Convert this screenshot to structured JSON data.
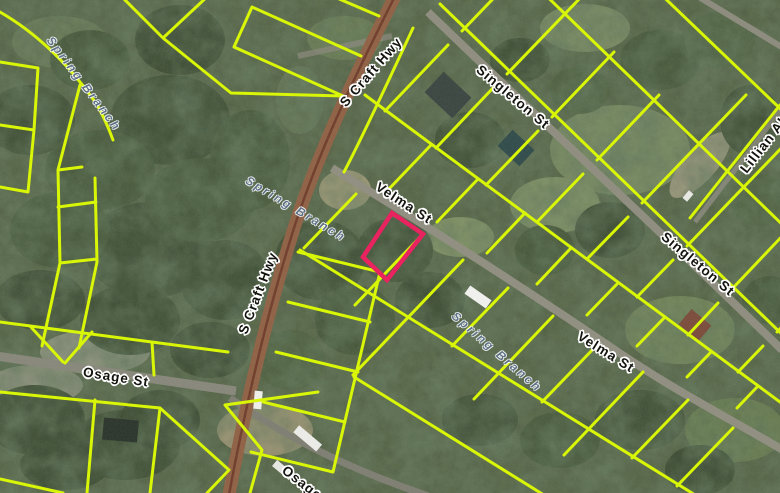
{
  "map": {
    "kind": "gis-parcel-viewer-aerial",
    "width": 780,
    "height": 493,
    "colors": {
      "parcel_line": "#d9f607",
      "highlight": "#e8235f",
      "highway_road": "#8f6044",
      "highway_centerline": "#6f3b2a",
      "local_road": "#8e8c7e",
      "road_label_text": "#14140f",
      "road_label_halo": "#ffffff",
      "stream_label_text": "#5d7186"
    },
    "road_labels": [
      {
        "text": "S Craft Hwy",
        "x": 371,
        "y": 72,
        "rotation": -49
      },
      {
        "text": "Singleton St",
        "x": 513,
        "y": 97,
        "rotation": 40
      },
      {
        "text": "Velma St",
        "x": 404,
        "y": 203,
        "rotation": 33
      },
      {
        "text": "S Craft Hwy",
        "x": 258,
        "y": 293,
        "rotation": -69
      },
      {
        "text": "Singleton St",
        "x": 698,
        "y": 264,
        "rotation": 40
      },
      {
        "text": "Velma St",
        "x": 606,
        "y": 352,
        "rotation": 32
      },
      {
        "text": "Osage St",
        "x": 116,
        "y": 377,
        "rotation": 9
      },
      {
        "text": "Osage St",
        "x": 310,
        "y": 489,
        "rotation": 38
      },
      {
        "text": "Lillian Aly",
        "x": 766,
        "y": 142,
        "rotation": -52
      }
    ],
    "stream_labels": [
      {
        "text": "Spring Branch",
        "x": 84,
        "y": 84,
        "rotation": 53
      },
      {
        "text": "Spring Branch",
        "x": 296,
        "y": 209,
        "rotation": 31
      },
      {
        "text": "Spring Branch",
        "x": 497,
        "y": 352,
        "rotation": 41
      }
    ],
    "highlighted_parcel": {
      "points": "392,213 423,234 387,280 363,257",
      "stroke": "#e8235f",
      "stroke_width": 4.5
    }
  }
}
